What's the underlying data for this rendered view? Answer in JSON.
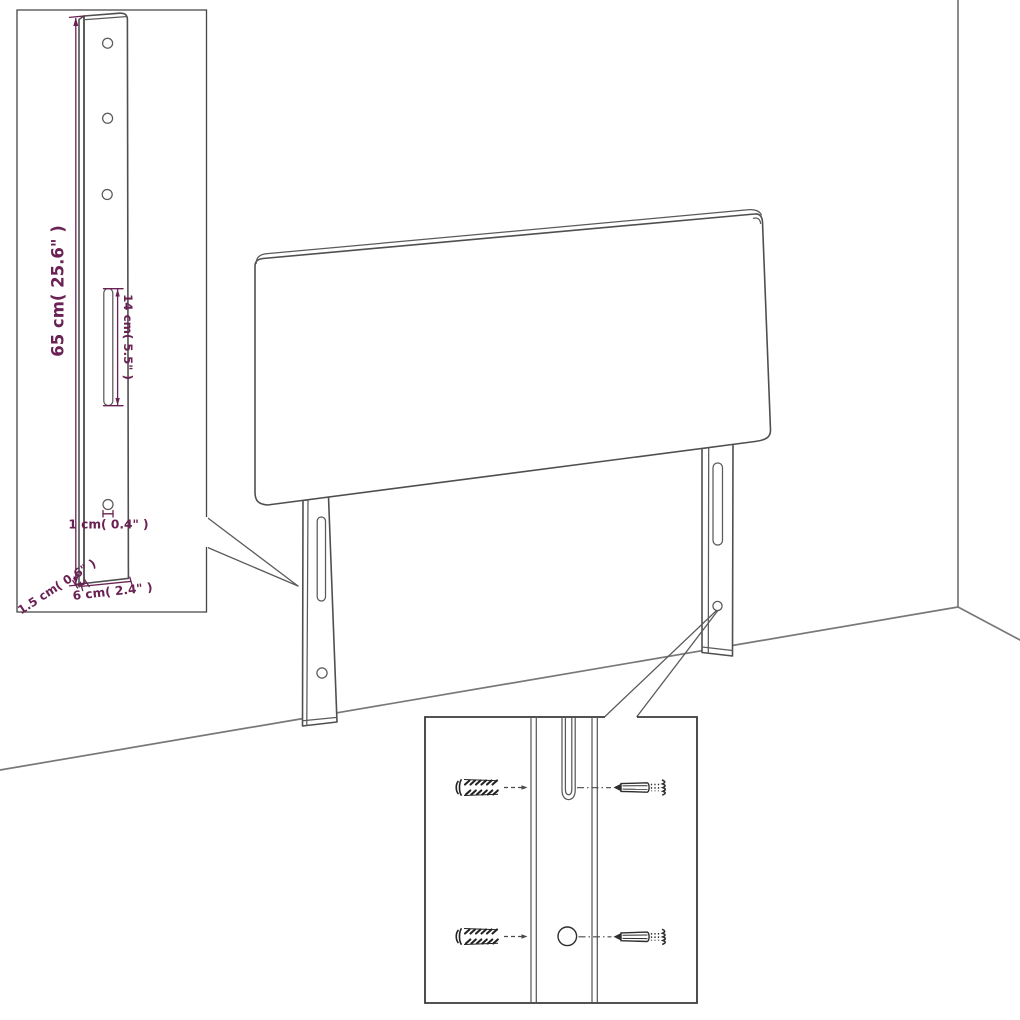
{
  "diagram": {
    "type": "furniture-assembly-dimension-drawing",
    "subject": "headboard with two mounting legs, wall/floor corner backdrop",
    "insets": [
      {
        "id": "post-detail",
        "position": "top-left",
        "content": "enlarged side view of mounting leg with holes and slot"
      },
      {
        "id": "screw-detail",
        "position": "bottom-center",
        "content": "wall plugs and screws aligned with leg slot and hole"
      }
    ],
    "labels": {
      "post_height": "65 cm( 25.6\" )",
      "slot_length": "14 cm( 5.5\" )",
      "hole_diameter": "1 cm( 0.4\" )",
      "post_thickness": "1.5 cm( 0.6\" )",
      "post_width": "6 cm( 2.4\" )"
    },
    "colors": {
      "dimension_text": "#6a2153",
      "drawing_outline": "#4f4f4f",
      "wall_lines": "#787878",
      "background": "#ffffff"
    },
    "counts": {
      "post_holes_top": 3,
      "wall_plugs": 2,
      "screws": 2
    }
  }
}
